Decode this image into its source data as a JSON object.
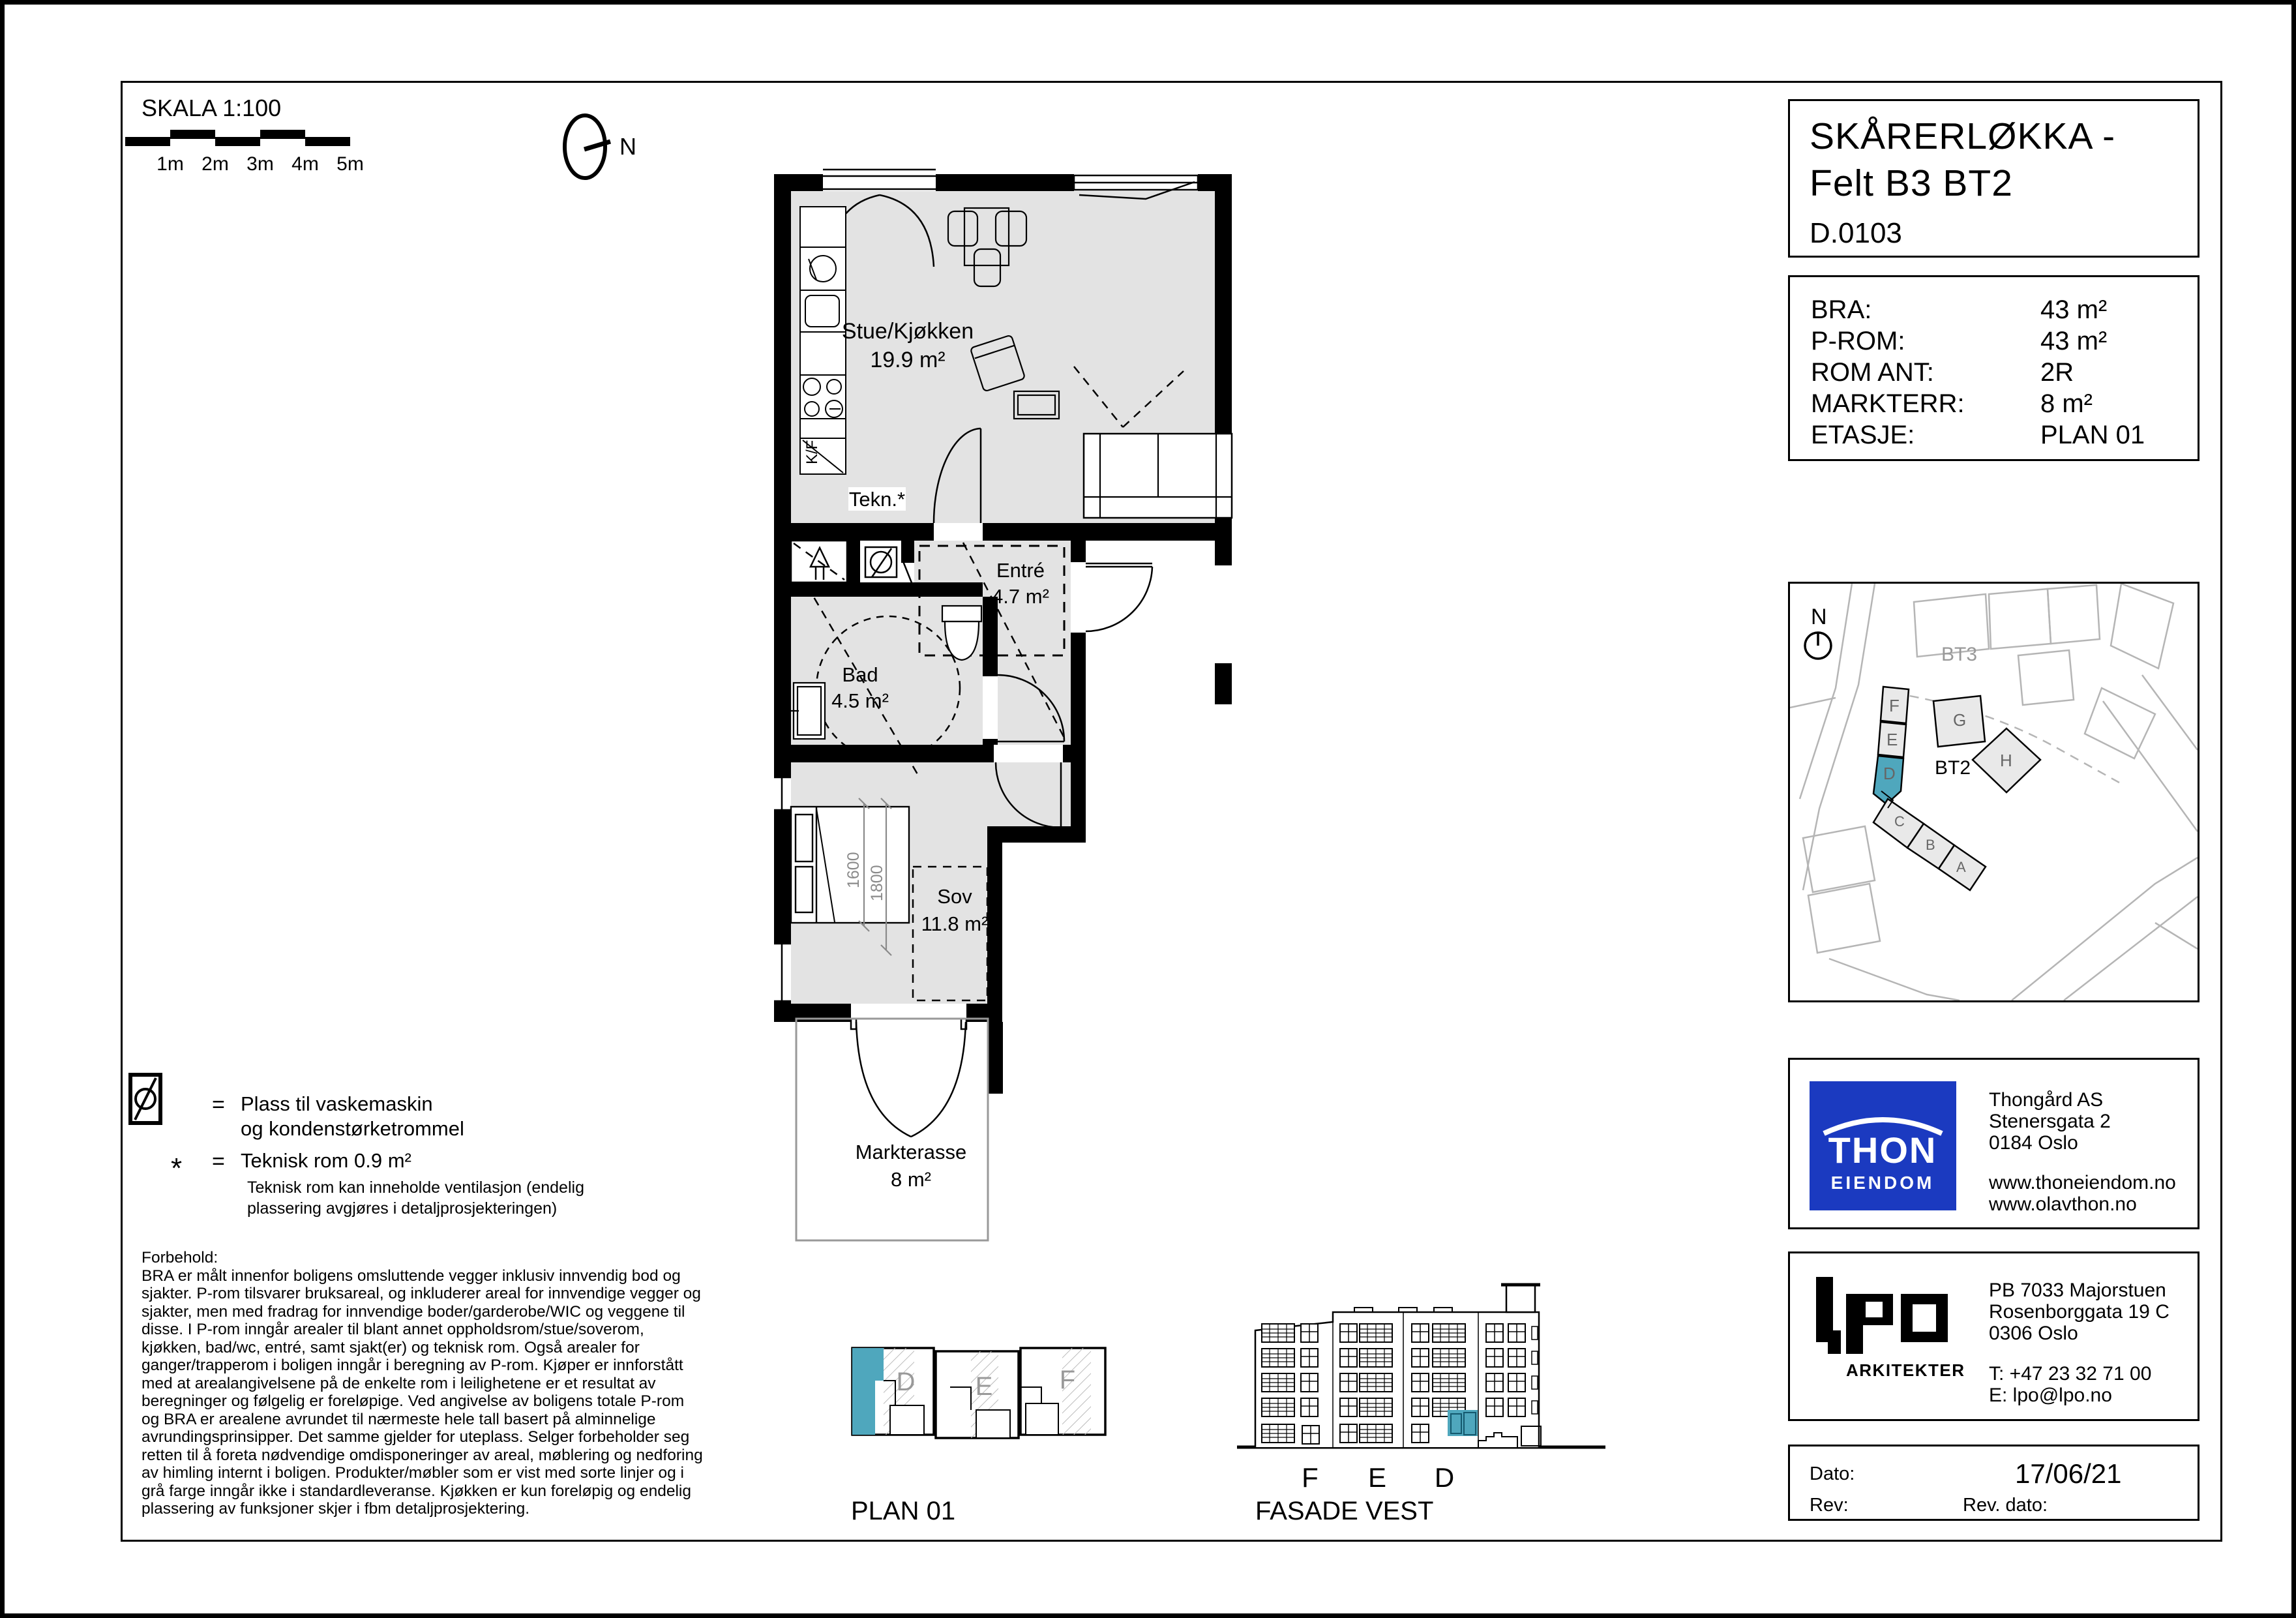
{
  "scale_bar": {
    "label": "SKALA 1:100",
    "ticks": [
      "1m",
      "2m",
      "3m",
      "4m",
      "5m"
    ],
    "north_label": "N"
  },
  "floor_plan": {
    "rooms": {
      "stue": {
        "name": "Stue/Kjøkken",
        "area": "19.9 m²"
      },
      "tekn": {
        "name": "Tekn.*"
      },
      "entre": {
        "name": "Entré",
        "area": "4.7 m²"
      },
      "bad": {
        "name": "Bad",
        "area": "4.5 m²"
      },
      "sov": {
        "name": "Sov",
        "area": "11.8 m²"
      },
      "terrasse": {
        "name": "Markterasse",
        "area": "8 m²"
      }
    },
    "labels": {
      "fridge": "K/F"
    },
    "bed_dimensions": [
      "1600",
      "1800"
    ]
  },
  "title_block": {
    "line1": "SKÅRERLØKKA -",
    "line2": "Felt B3 BT2",
    "line3": "D.0103"
  },
  "unit_info": {
    "rows": [
      {
        "label": "BRA:",
        "value": "43 m²"
      },
      {
        "label": "P-ROM:",
        "value": "43 m²"
      },
      {
        "label": "ROM ANT:",
        "value": "2R"
      },
      {
        "label": "MARKTERR:",
        "value": "8 m²"
      },
      {
        "label": "ETASJE:",
        "value": "PLAN 01"
      }
    ]
  },
  "site_plan": {
    "north_label": "N",
    "bt3": "BT3",
    "bt2": "BT2",
    "buildings": {
      "a": "A",
      "b": "B",
      "c": "C",
      "d": "D",
      "e": "E",
      "f": "F",
      "g": "G",
      "h": "H"
    }
  },
  "developer": {
    "logo_line1": "THON",
    "logo_line2": "EIENDOM",
    "lines": [
      "Thongård AS",
      "Stenersgata 2",
      "0184 Oslo"
    ],
    "websites": [
      "www.thoneiendom.no",
      "www.olavthon.no"
    ]
  },
  "architect": {
    "logo_text": "lpo",
    "logo_sub": "ARKITEKTER",
    "lines": [
      "PB 7033 Majorstuen",
      "Rosenborggata 19 C",
      "0306 Oslo"
    ],
    "phone": "T: +47 23 32 71 00",
    "email": "E: lpo@lpo.no"
  },
  "revision": {
    "dato_label": "Dato:",
    "dato_value": "17/06/21",
    "rev_label": "Rev:",
    "rev_dato_label": "Rev. dato:"
  },
  "legend": {
    "wm_equals": "=",
    "wm_line1": "Plass til vaskemaskin",
    "wm_line2": "og kondenstørketrommel",
    "star": "*",
    "star_equals": "=",
    "star_text": "Teknisk rom 0.9 m²",
    "star_note1": "Teknisk rom kan inneholde ventilasjon (endelig",
    "star_note2": "plassering avgjøres i detaljprosjekteringen)"
  },
  "disclaimer": {
    "title": "Forbehold:",
    "body": "BRA er målt innenfor boligens omsluttende vegger inklusiv innvendig bod og sjakter. P-rom tilsvarer bruksareal, og inkluderer areal for innvendige vegger og sjakter, men med fradrag for innvendige boder/garderobe/WIC og veggene til disse. I P-rom inngår arealer til blant annet oppholdsrom/stue/soverom, kjøkken, bad/wc, entré, samt sjakt(er) og teknisk rom. Også arealer for ganger/trapperom i boligen inngår i beregning av P-rom. Kjøper er innforstått med at arealangivelsene på de enkelte rom i leilighetene er et resultat av beregninger og følgelig er foreløpige. Ved angivelse av boligens totale P-rom og BRA er arealene avrundet til nærmeste hele tall basert på alminnelige avrundingsprinsipper. Det samme gjelder for uteplass. Selger forbeholder seg retten til å foreta nødvendige omdisponeringer av areal, møblering og nedforing av himling internt i boligen. Produkter/møbler som er vist med sorte linjer og i grå farge inngår ikke i standardleveranse. Kjøkken er kun foreløpig og endelig plassering av funksjoner skjer i fbm  detaljprosjektering."
  },
  "key_plan": {
    "caption": "PLAN 01",
    "units": {
      "d": "D",
      "e": "E",
      "f": "F"
    }
  },
  "facade": {
    "caption": "FASADE VEST",
    "sections": {
      "f": "F",
      "e": "E",
      "d": "D"
    }
  },
  "colors": {
    "highlight_teal": "#4FA7BD",
    "floor_gray": "#E3E3E3",
    "thon_blue": "#1B3AC0"
  }
}
